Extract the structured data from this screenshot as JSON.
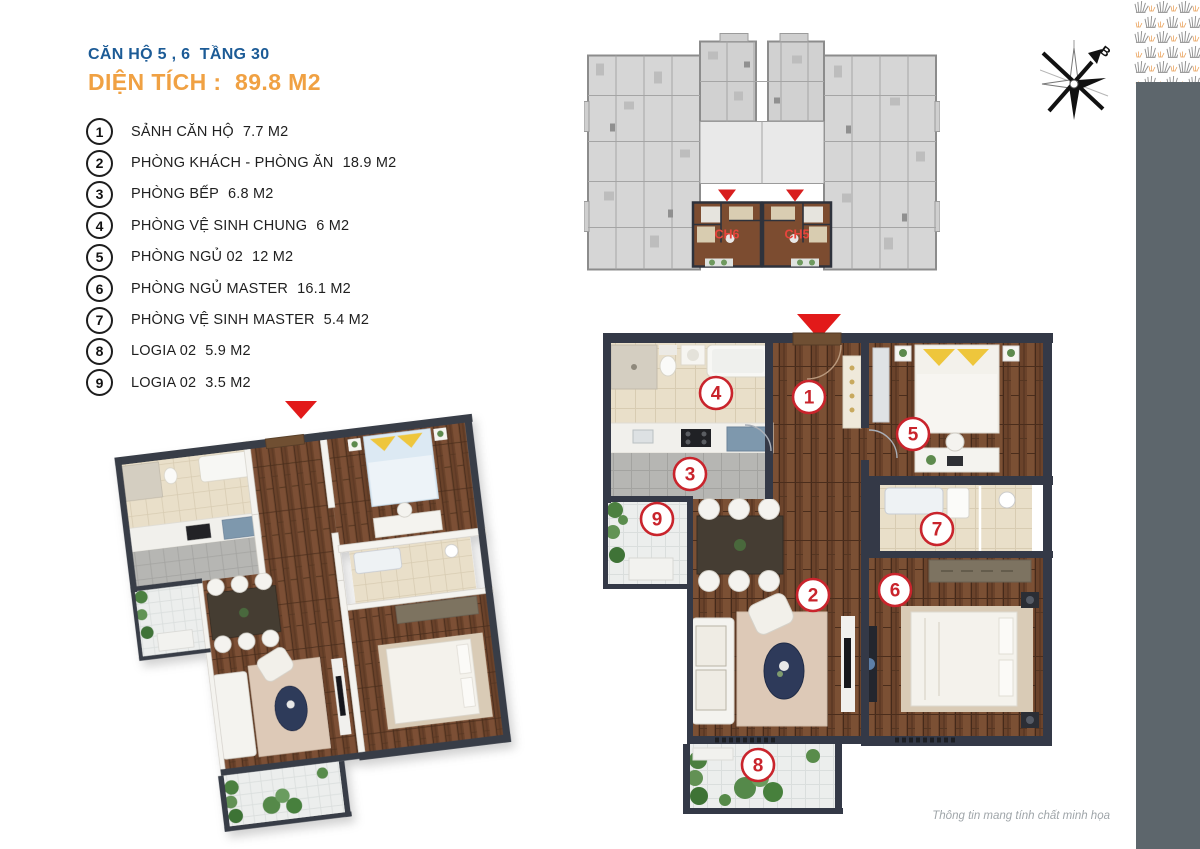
{
  "header": {
    "subtitle": "CĂN HỘ 5 , 6  TẦNG 30",
    "title": "DIỆN TÍCH :  89.8 M2"
  },
  "legend": {
    "items": [
      {
        "num": "1",
        "name": "SẢNH CĂN HỘ",
        "area": "7.7 M2"
      },
      {
        "num": "2",
        "name": "PHÒNG KHÁCH - PHÒNG ĂN",
        "area": "18.9 M2"
      },
      {
        "num": "3",
        "name": "PHÒNG BẾP",
        "area": "6.8 M2"
      },
      {
        "num": "4",
        "name": "PHÒNG VỆ SINH CHUNG",
        "area": "6 M2"
      },
      {
        "num": "5",
        "name": "PHÒNG NGỦ 02",
        "area": "12 M2"
      },
      {
        "num": "6",
        "name": "PHÒNG NGỦ MASTER",
        "area": "16.1 M2"
      },
      {
        "num": "7",
        "name": "PHÒNG VỆ SINH MASTER",
        "area": "5.4 M2"
      },
      {
        "num": "8",
        "name": "LOGIA 02",
        "area": "5.9 M2"
      },
      {
        "num": "9",
        "name": "LOGIA 02",
        "area": "3.5 M2"
      }
    ]
  },
  "keyplan": {
    "units": [
      {
        "label": "CH6"
      },
      {
        "label": "CH5"
      }
    ]
  },
  "compass": {
    "north_label": "B"
  },
  "plan2d": {
    "markers": [
      "1",
      "2",
      "3",
      "4",
      "5",
      "6",
      "7",
      "8",
      "9"
    ]
  },
  "footer": {
    "note": "Thông tin mang tính chất minh họa"
  },
  "colors": {
    "title_blue": "#1c5b96",
    "accent_orange": "#f0a143",
    "marker_red": "#c9242c",
    "arrow_red": "#e21a1a",
    "unit_label_red": "#e8453c",
    "sidebar_gray": "#5d666c",
    "wall_dark": "#343947",
    "wood_brown": "#6b432b"
  }
}
